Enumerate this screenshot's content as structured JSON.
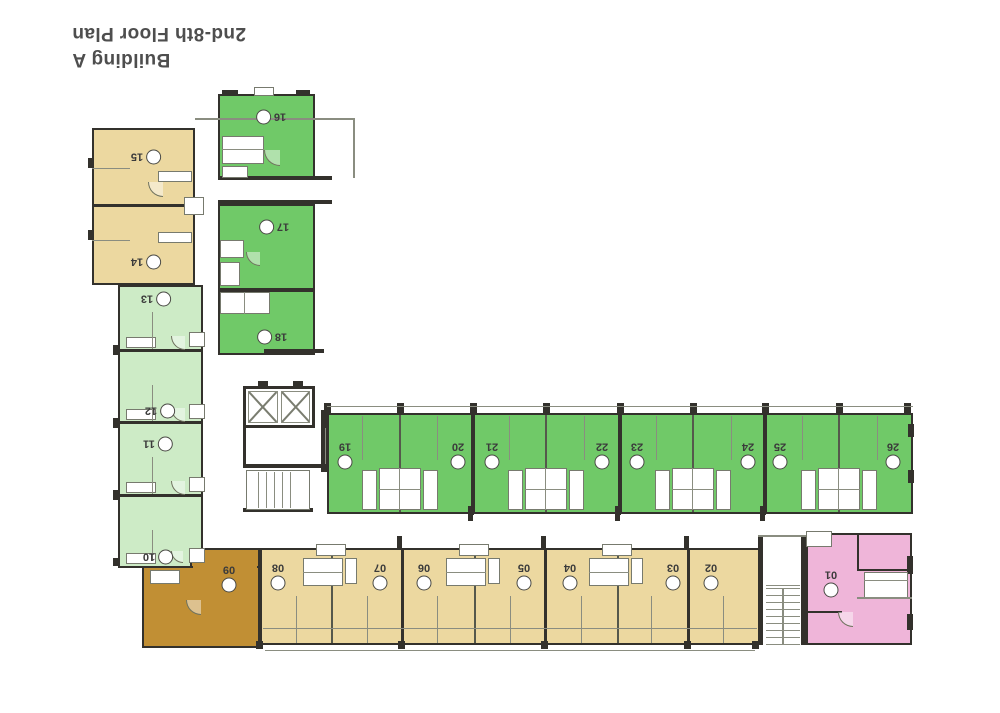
{
  "title": {
    "line1": "Building A",
    "line2": "2nd-8th Floor Plan"
  },
  "plan": {
    "zones": {
      "north_tan_block": {
        "units": [
          "15",
          "14"
        ]
      },
      "north_green_column": {
        "units": [
          "16",
          "17",
          "18"
        ]
      },
      "west_wing": {
        "units": [
          "13",
          "12",
          "11",
          "10"
        ]
      },
      "central_green_row": {
        "units": [
          "19",
          "20",
          "21",
          "22",
          "23",
          "24",
          "25",
          "26"
        ]
      },
      "south_row": {
        "units": [
          "08",
          "07",
          "06",
          "05",
          "04",
          "03",
          "02"
        ]
      },
      "south_brown_unit": {
        "units": [
          "09"
        ]
      },
      "south_pink_unit": {
        "units": [
          "01"
        ]
      }
    },
    "colors": {
      "wall": "#33312c",
      "unit_tan": "#ecd8a0",
      "unit_green": "#70c968",
      "unit_light_green": "#cdebc6",
      "unit_brown": "#c18f34",
      "unit_pink": "#efb5d9"
    }
  }
}
